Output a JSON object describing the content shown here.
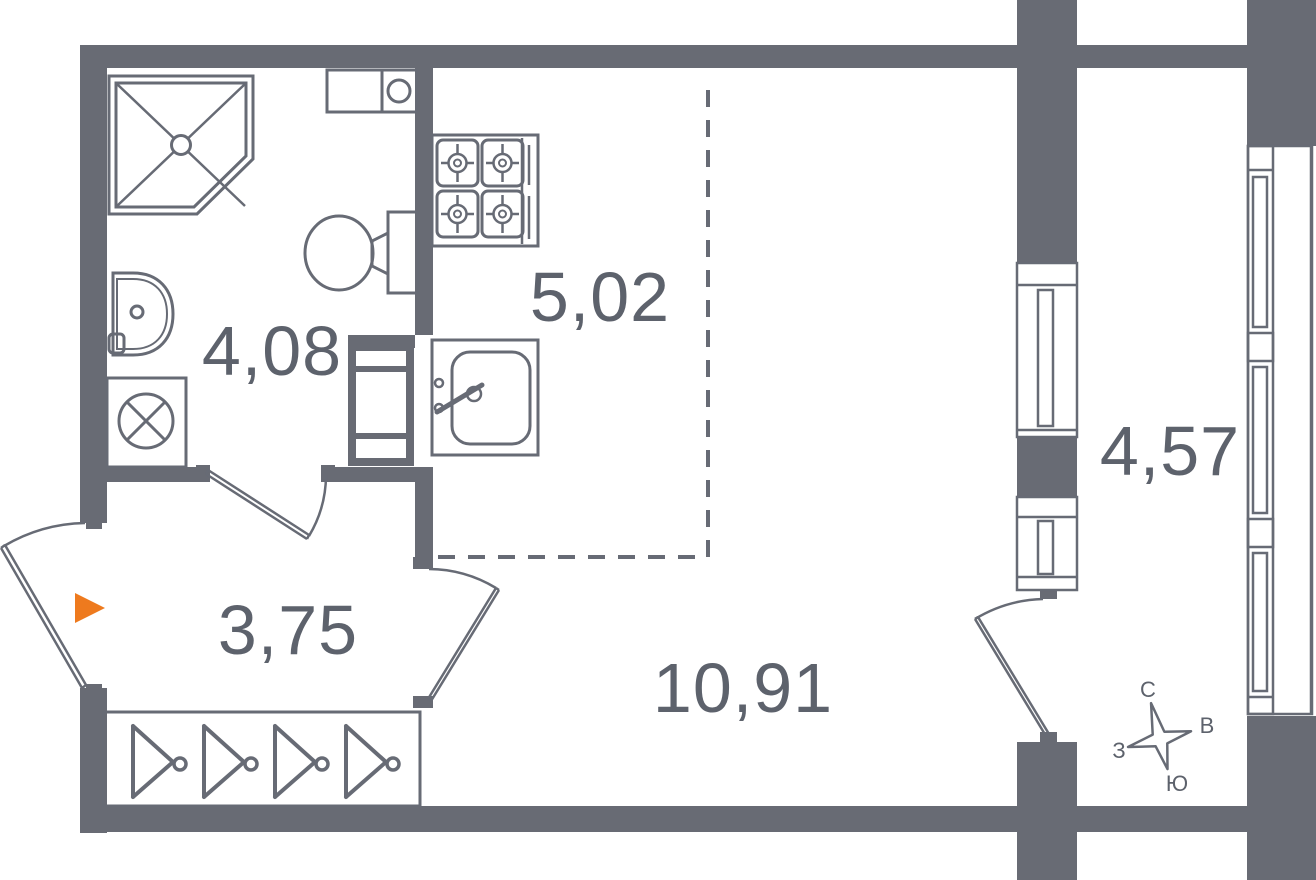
{
  "plan": {
    "rooms": {
      "bathroom": {
        "label": "bathroom",
        "area": "4,08"
      },
      "kitchen": {
        "label": "kitchen",
        "area": "5,02"
      },
      "hallway": {
        "label": "hallway",
        "area": "3,75"
      },
      "living_room": {
        "label": "living-room",
        "area": "10,91"
      },
      "balcony": {
        "label": "balcony",
        "area": "4,57"
      }
    },
    "compass": {
      "north": "С",
      "east": "В",
      "south": "Ю",
      "west": "З"
    },
    "colors": {
      "wall": "#686b74",
      "line": "#676b75",
      "text": "#5d626c",
      "accent": "#ee7a1e",
      "background": "#ffffff"
    },
    "fixtures": {
      "bathroom": [
        "shower-cabin",
        "washbasin",
        "washing-machine",
        "toilet",
        "water-heater"
      ],
      "kitchen": [
        "gas-stove",
        "kitchen-sink"
      ],
      "hallway": [
        "wardrobe-hangers",
        "entrance-arrow"
      ],
      "doors": [
        "entrance-door",
        "bathroom-door",
        "room-door",
        "balcony-door"
      ],
      "windows": [
        "room-balcony-window",
        "balcony-glazing"
      ]
    }
  }
}
